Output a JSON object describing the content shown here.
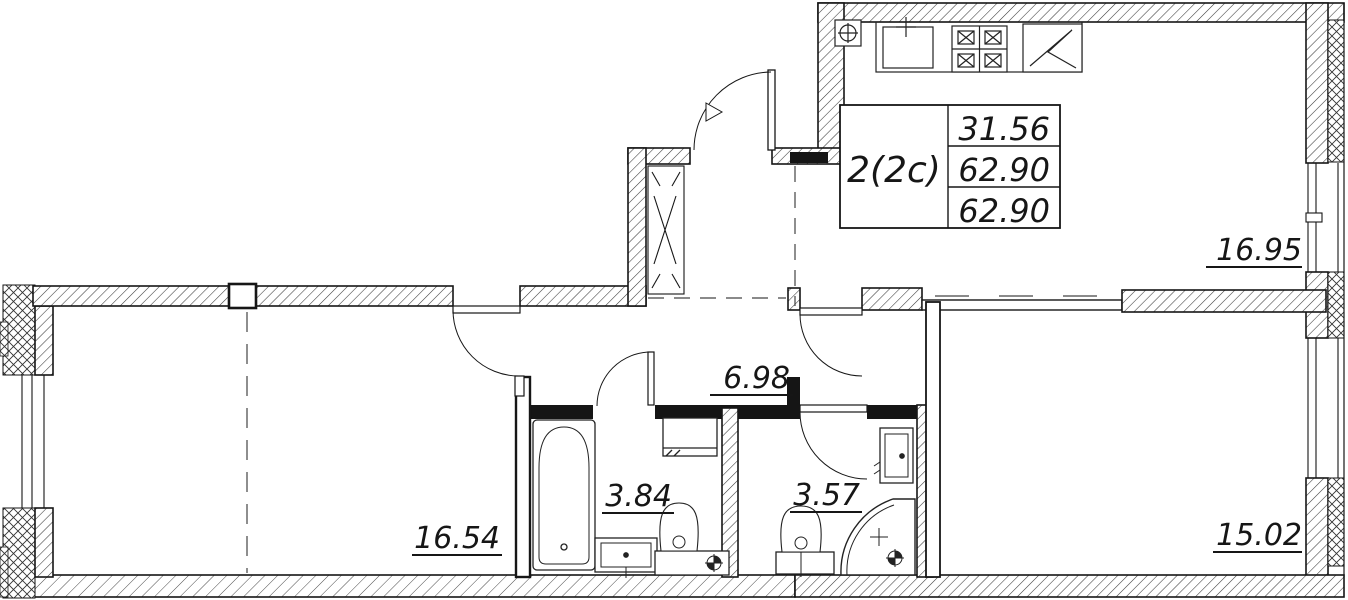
{
  "plan": {
    "info_table": {
      "unit_type": "2(2c)",
      "rows": [
        "31.56",
        "62.90",
        "62.90"
      ]
    },
    "rooms": [
      {
        "name": "kitchen-living-room",
        "area": "16.95"
      },
      {
        "name": "hallway",
        "area": "6.98"
      },
      {
        "name": "bathroom",
        "area": "3.84"
      },
      {
        "name": "shower-wc",
        "area": "3.57"
      },
      {
        "name": "living-room",
        "area": "16.54"
      },
      {
        "name": "bedroom",
        "area": "15.02"
      }
    ],
    "fixtures": [
      "kitchen-sink",
      "stove-4-burner",
      "refrigerator",
      "gas-meter",
      "ventilation-shaft",
      "bathtub",
      "washbasin",
      "toilet",
      "water-heater",
      "toilet",
      "washbasin",
      "corner-shower",
      "floor-drain"
    ],
    "colors": {
      "line": "#161616",
      "wall_fill_dark": "#151515",
      "background": "#ffffff"
    }
  }
}
